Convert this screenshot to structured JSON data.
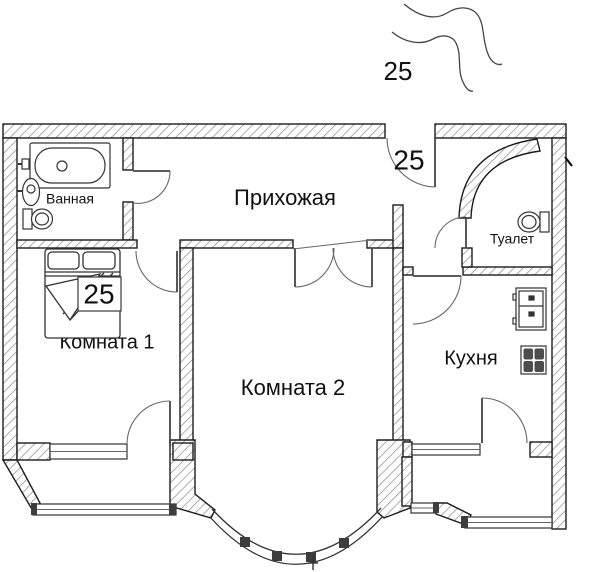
{
  "rooms": {
    "bathroom": {
      "label": "Ванная"
    },
    "hallway": {
      "label": "Прихожая"
    },
    "toilet": {
      "label": "Туалет"
    },
    "room1": {
      "label": "Комната 1"
    },
    "room2": {
      "label": "Комната 2"
    },
    "kitchen": {
      "label": "Кухня"
    }
  },
  "annotations": {
    "handwritten_top": "25",
    "entrance": "25",
    "bed": "25"
  },
  "icons": [
    "bathtub-icon",
    "sink-icon",
    "toilet-icon",
    "bed-icon",
    "fridge-icon",
    "stove-icon",
    "window-icon",
    "door-arc-icon",
    "squiggle-lines"
  ],
  "colors": {
    "background": "#ffffff",
    "wall_outline": "#1c1c1c",
    "hatch_line": "#8a8a8a",
    "door_line": "#555555",
    "fixture_line": "#333333",
    "text": "#111111"
  }
}
